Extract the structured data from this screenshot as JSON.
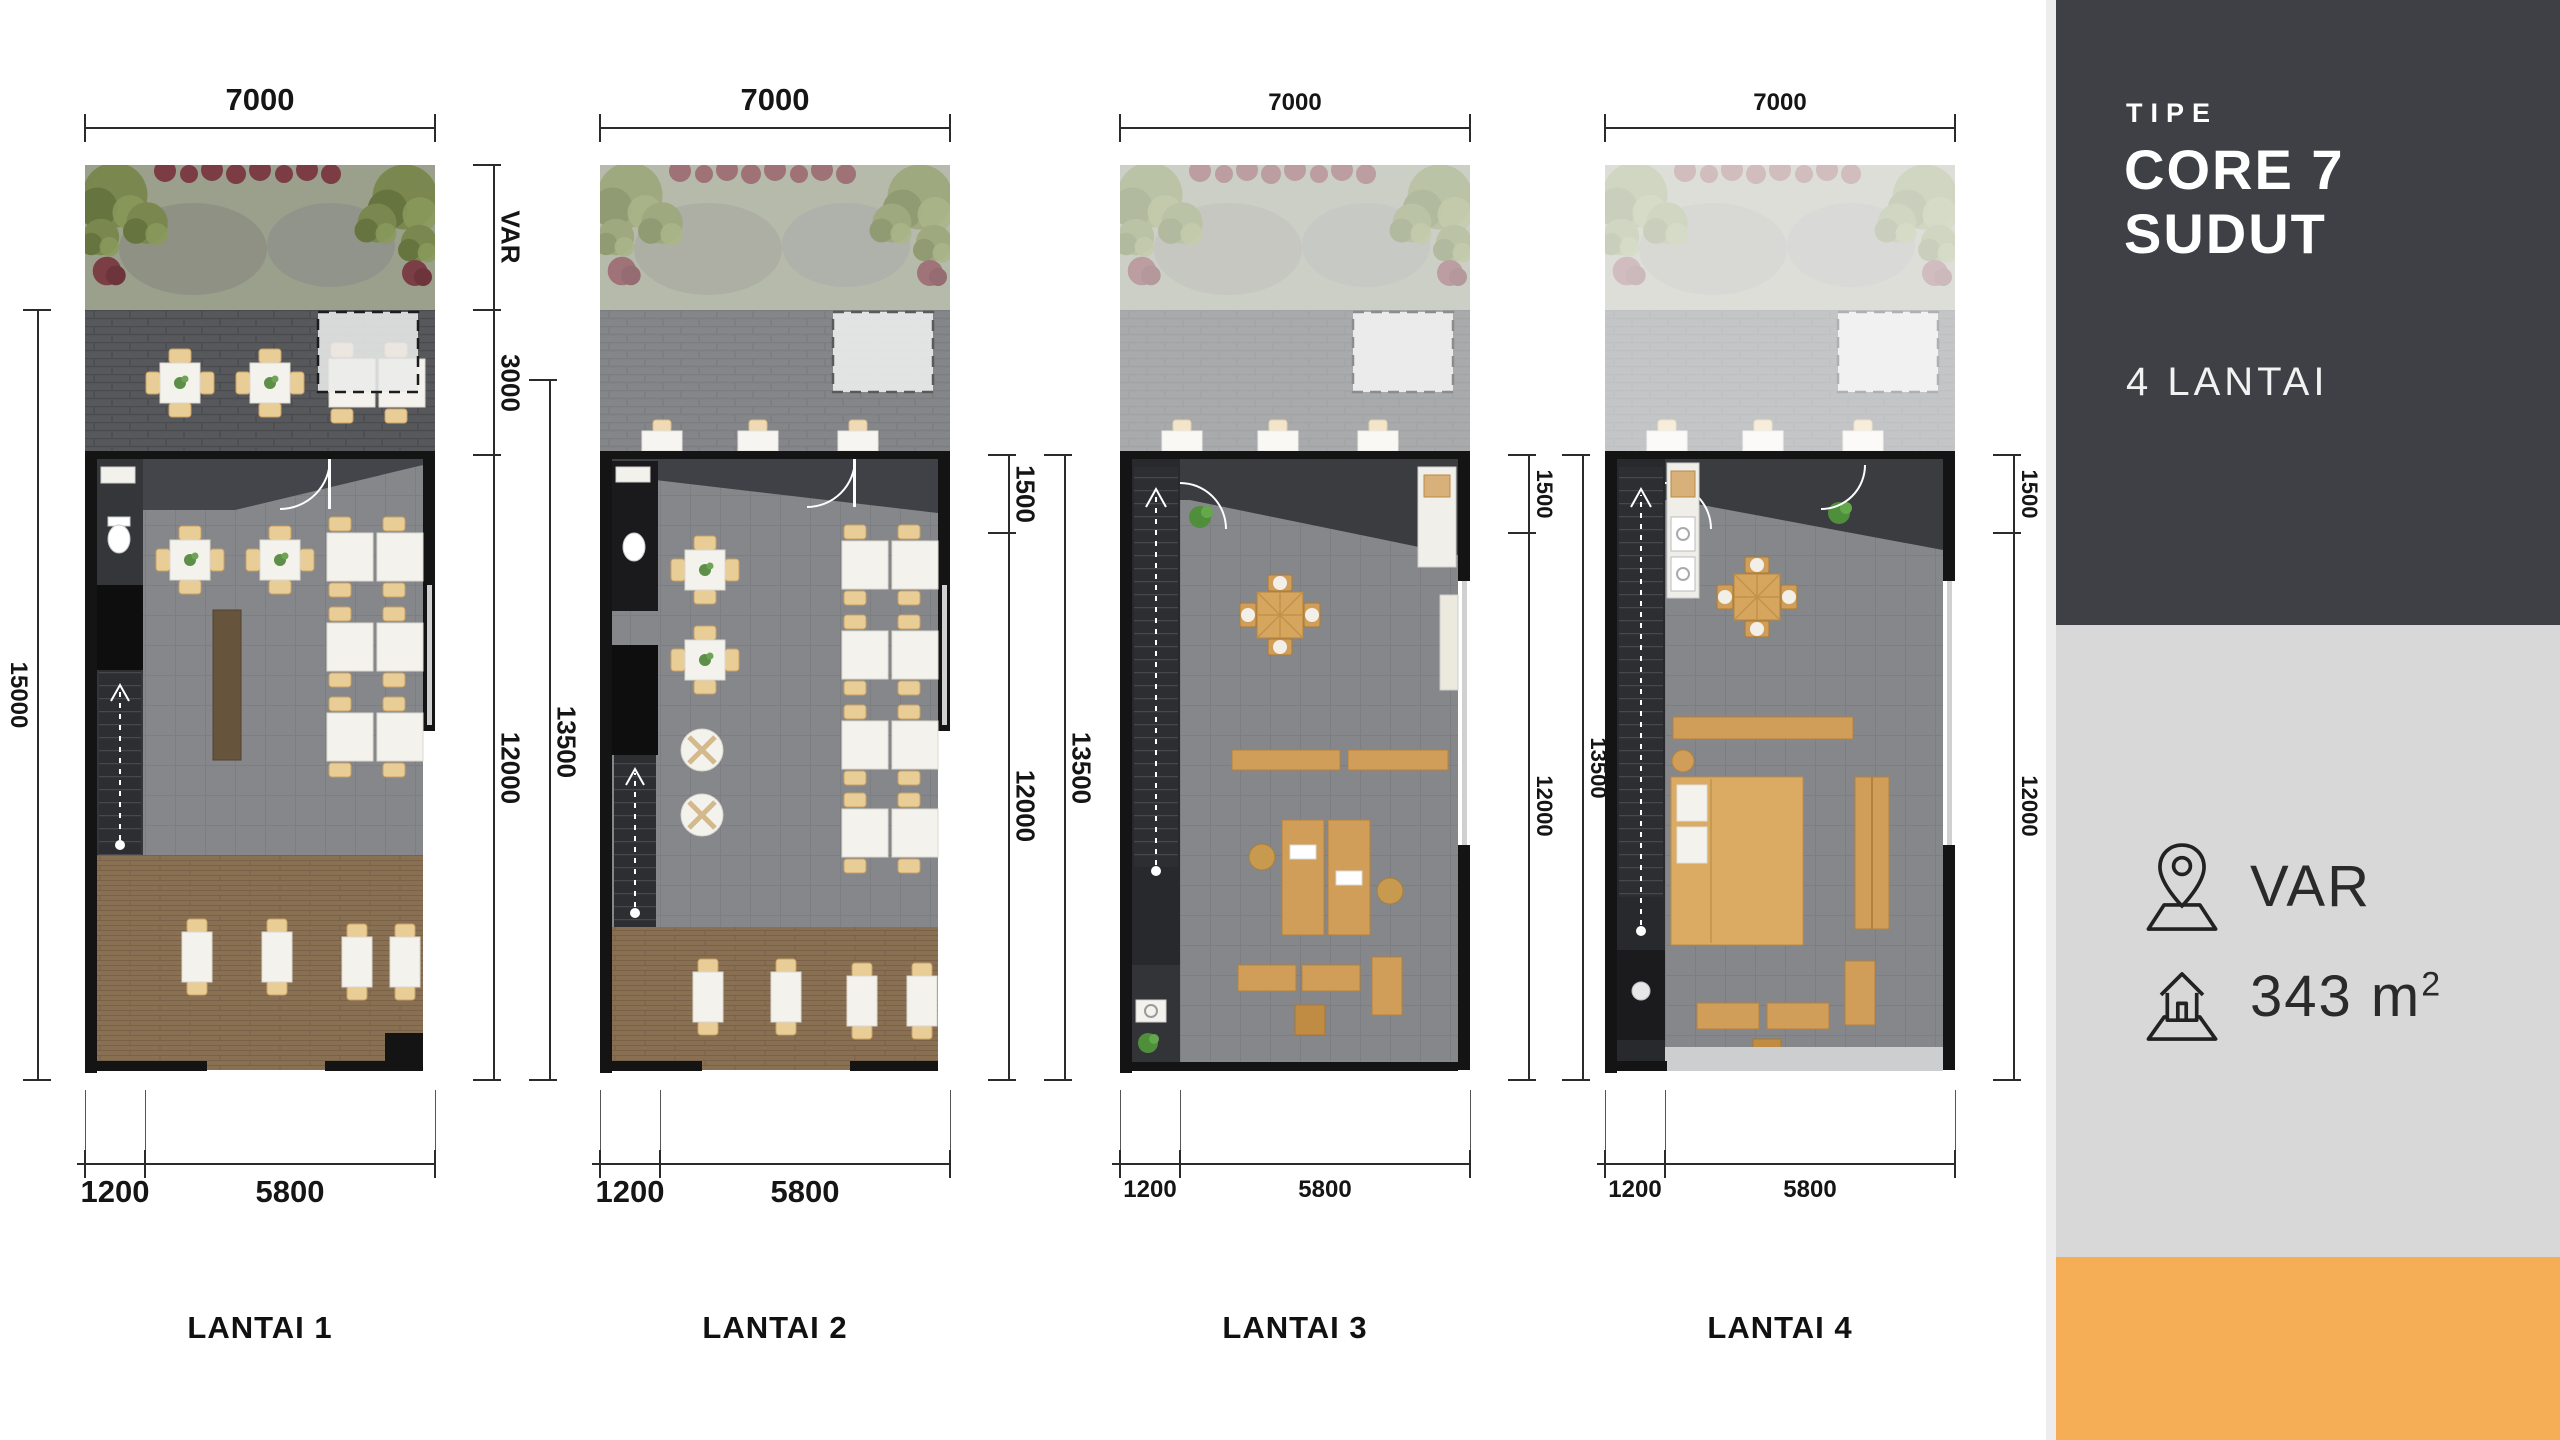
{
  "panel": {
    "type_label": "TIPE",
    "type_line1": "CORE 7",
    "type_line2": "SUDUT",
    "floors_text": "4 LANTAI",
    "location_value": "VAR",
    "area_value": "343 m",
    "area_sup": "2",
    "colors": {
      "dark": "#3e4046",
      "light": "#d8d8d8",
      "accent": "#f5ae56"
    }
  },
  "plans": [
    {
      "label": "LANTAI 1",
      "top_dim": "7000",
      "left_dim": "15000",
      "right_dims": [
        "VAR",
        "3000",
        "12000"
      ],
      "outer_right_dim": "13500",
      "bottom_dims": [
        "1200",
        "5800"
      ]
    },
    {
      "label": "LANTAI 2",
      "top_dim": "7000",
      "right_dims": [
        "1500",
        "12000"
      ],
      "outer_right_dim": "13500",
      "bottom_dims": [
        "1200",
        "5800"
      ]
    },
    {
      "label": "LANTAI 3",
      "top_dim": "7000",
      "right_dims": [
        "1500",
        "12000"
      ],
      "outer_right_dim": "13500",
      "bottom_dims": [
        "1200",
        "5800"
      ]
    },
    {
      "label": "LANTAI 4",
      "top_dim": "7000",
      "right_dims": [
        "1500",
        "12000"
      ],
      "bottom_dims": [
        "1200",
        "5800"
      ]
    }
  ]
}
